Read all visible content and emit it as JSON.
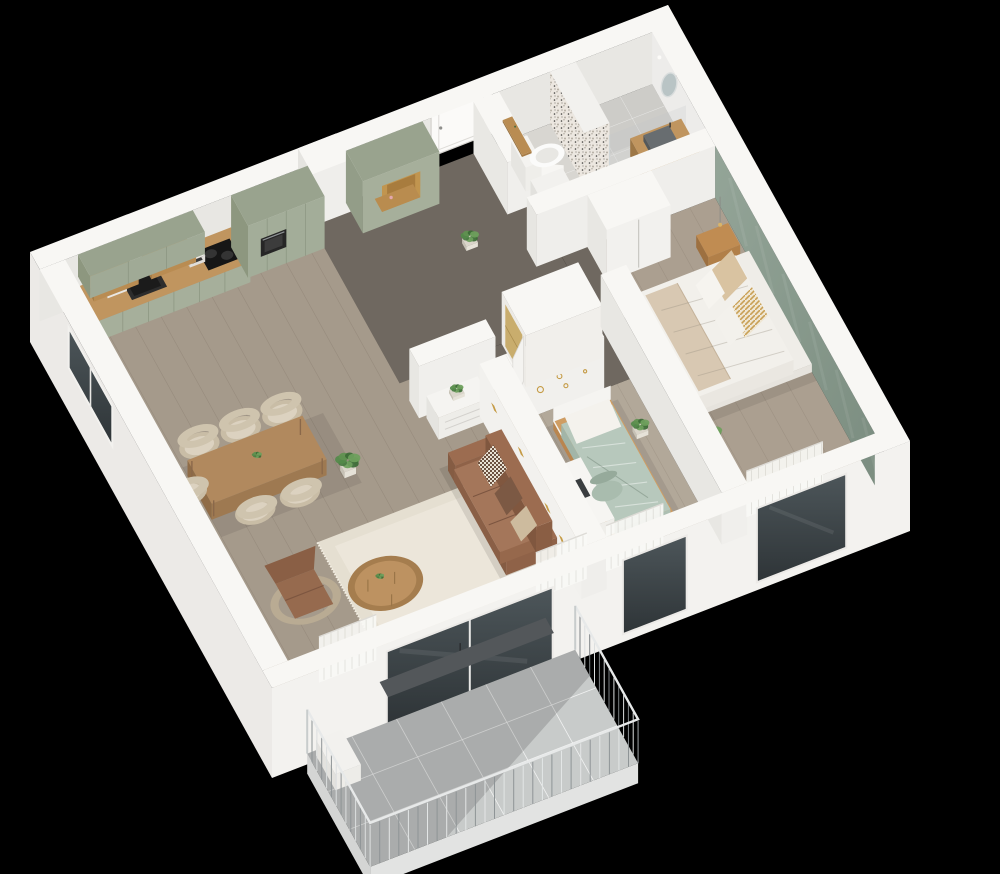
{
  "image": {
    "type": "3d-isometric-floor-plan",
    "subject": "apartment cutaway render viewed from above",
    "background": "#000000"
  },
  "rooms": [
    {
      "id": "kitchen",
      "label": "Kitchen",
      "items": [
        "kitchen-counter",
        "kitchen-sink",
        "cooktop",
        "oven",
        "upper-cabinets",
        "open-shelves",
        "tall-cabinets",
        "coffee-machine",
        "toaster",
        "ventilation-duct"
      ]
    },
    {
      "id": "entry-hall",
      "label": "Entry hall",
      "items": [
        "entry-door",
        "entry-wardrobe",
        "bench-niche",
        "potted-plant",
        "storage-closet",
        "hallway-dresser"
      ]
    },
    {
      "id": "bathroom",
      "label": "Bathroom",
      "items": [
        "toilet",
        "terrazzo-shower-wall",
        "vanity-unit",
        "wash-basin",
        "oval-mirror",
        "washing-machine",
        "wood-shelf"
      ]
    },
    {
      "id": "master-bedroom",
      "label": "Master bedroom",
      "items": [
        "double-bed",
        "pillows",
        "nightstand",
        "pendant-lamp",
        "wardrobe",
        "green-accent-wall",
        "potted-plant",
        "sheer-curtain",
        "window"
      ]
    },
    {
      "id": "kids-bedroom",
      "label": "Kids bedroom",
      "items": [
        "single-bed",
        "desk",
        "desk-chair",
        "closet-open-door",
        "gold-wall-decals",
        "potted-plant",
        "sheer-curtain",
        "window"
      ]
    },
    {
      "id": "living-dining",
      "label": "Living and dining room",
      "items": [
        "dining-table",
        "dining-chairs",
        "lounge-chair",
        "leather-sofa",
        "sofa-pillows",
        "coffee-table",
        "area-rug",
        "potted-plants",
        "floor-vase",
        "curtains",
        "balcony-door",
        "side-window"
      ]
    },
    {
      "id": "balcony",
      "label": "Balcony",
      "items": [
        "tiled-floor",
        "metal-railing",
        "planter-box"
      ]
    }
  ],
  "counts": {
    "dining_chairs": 6,
    "bedrooms": 2,
    "balconies": 1
  },
  "palette": {
    "background": "#000000",
    "wall_top": "#f8f7f4",
    "wall_inner": "#e8e7e3",
    "wall_outer": "#f3f2ef",
    "wall_outer_left": "#eceae7",
    "floor_living": "#a59a8b",
    "floor_hall": "#6f6860",
    "floor_kids": "#b2a899",
    "floor_master": "#ab9f90",
    "floor_bath": "#d8d6d1",
    "floor_balcony": "#c8cbca",
    "kitchen_green": "#a6af9b",
    "kitchen_green_dark": "#99a38e",
    "counter_wood": "#c0955f",
    "wood_accent": "#b98c52",
    "sofa_leather": "#9c6c50",
    "armchair_leather": "#966a4e",
    "rug": "#e5dfd1",
    "table_wood": "#b1895e",
    "chair_fabric": "#dcd2c0",
    "bed_white": "#f2f0eb",
    "pillow_beige": "#d9c3a1",
    "throw_beige": "#d8c8b2",
    "kids_bedding": "#b7c8bc",
    "bed_wood": "#cc9a61",
    "green_wall": "#8a9b8f",
    "terrazzo_base": "#ece7e0",
    "glass_dark": "#3b4246",
    "metal_rail": "#e7e9e9",
    "metal_dark": "#8e9496",
    "plant_green": "#5f9150",
    "plant_dark": "#3c6b36",
    "gold": "#c59b45",
    "closet_gold": "#c9ad6d",
    "basin_gray": "#686d70",
    "mirror": "#b9c4c5",
    "pink_bag": "#e2a7ad"
  }
}
